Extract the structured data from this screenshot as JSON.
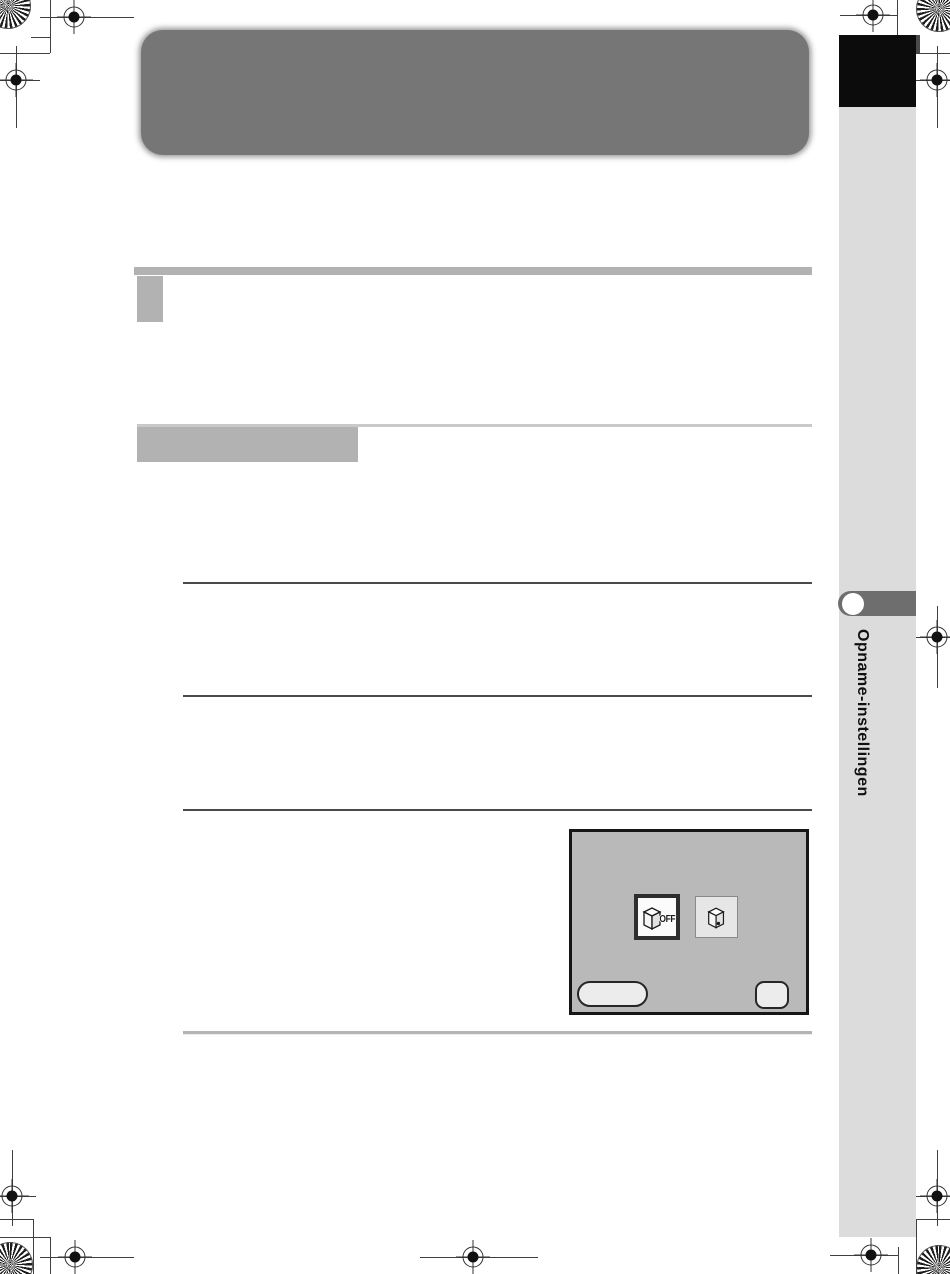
{
  "page": {
    "width": 950,
    "height": 1274,
    "background": "#ffffff",
    "kind": "scanned-manual-page"
  },
  "header": {
    "banner_color": "#767676"
  },
  "sections": {
    "bar_color": "#b2b2b2",
    "thin_line_color": "#c9c9c9",
    "rule_dark_color": "#4a4a4a",
    "rule_light_color": "#b4b4b4"
  },
  "sidebar": {
    "tab_label": "Opname-instellingen",
    "strip_color": "#dcdcdc",
    "black_tab_color": "#0c0c0c",
    "round_tab_color": "#6e6e6e",
    "label_color": "#111111"
  },
  "camera_screen": {
    "background": "#b9b9b9",
    "border_color": "#161616",
    "options": [
      {
        "name": "option-off",
        "icon": "sensor-unit-icon",
        "label": "OFF",
        "selected": true
      },
      {
        "name": "option-on",
        "icon": "sensor-unit-dust-icon",
        "label": "",
        "selected": false
      }
    ],
    "buttons": [
      {
        "name": "pill-button",
        "shape": "pill",
        "label": ""
      },
      {
        "name": "square-button",
        "shape": "rounded-square",
        "label": ""
      }
    ]
  },
  "print_marks": {
    "registration_mark": "registration-mark-icon",
    "color_wheel": "color-wheel-icon",
    "line_color": "#3f3f3f"
  }
}
